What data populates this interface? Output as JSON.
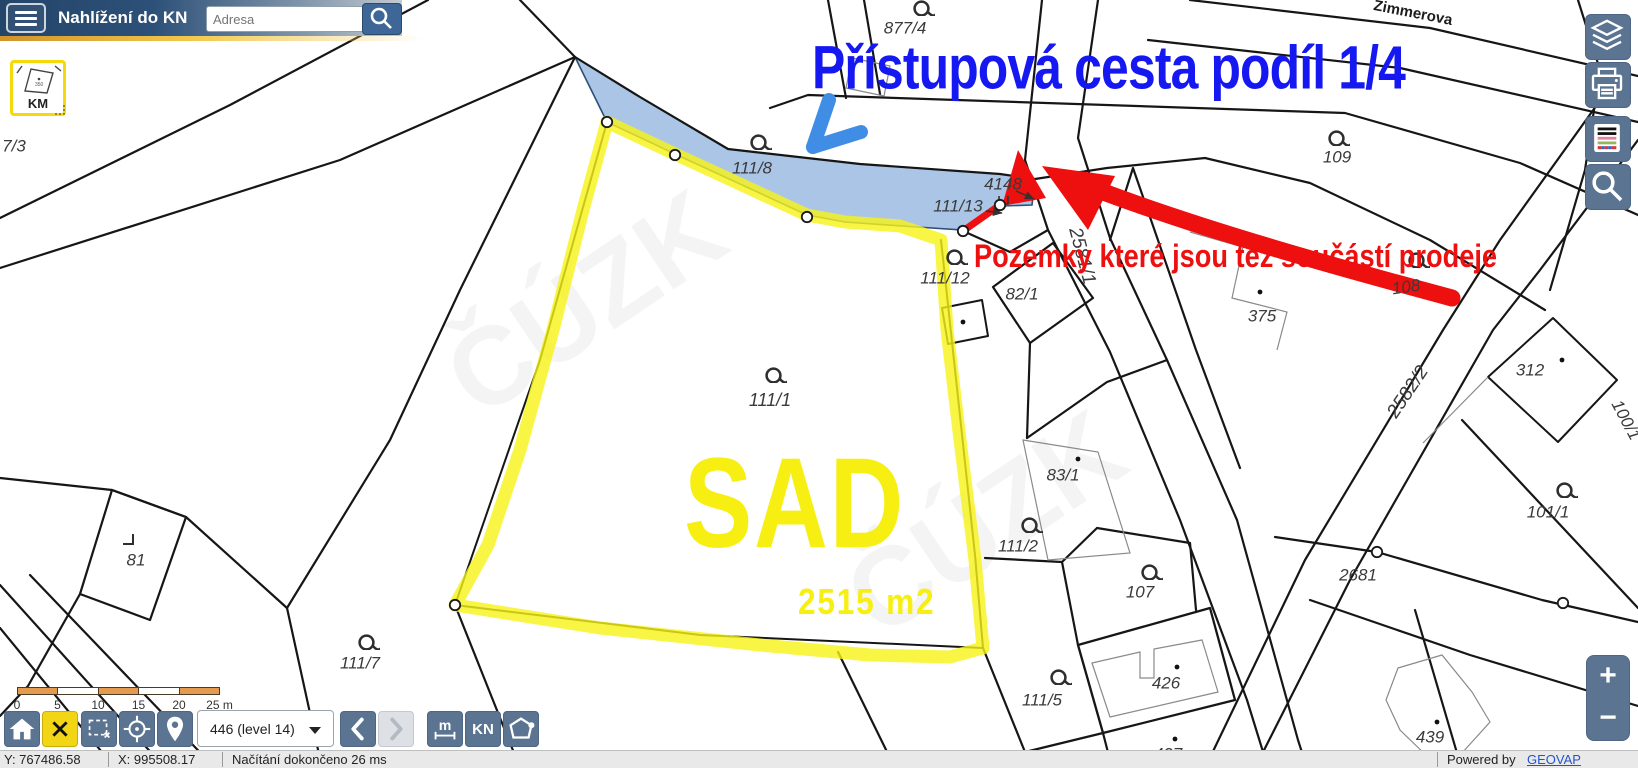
{
  "header": {
    "title": "Nahlížení do KN",
    "search_placeholder": "Adresa"
  },
  "km_button": {
    "label": "KM",
    "mini_number": "350"
  },
  "right_toolbar": {
    "icons": [
      "layers-icon",
      "print-icon",
      "legend-icon",
      "search-icon"
    ]
  },
  "annotations": {
    "blue_text": "Přístupová cesta podíl 1/4",
    "red_text": "Pozemky které jsou též součástí prodeje",
    "sad_label": "SAD",
    "area_label": "2515 m2"
  },
  "map": {
    "street_name": "Zimmerova",
    "watermark": "ČÚZK",
    "labels": [
      {
        "t": "877/4",
        "x": 905,
        "y": 28
      },
      {
        "t": "7/3",
        "x": 14,
        "y": 146
      },
      {
        "t": "111/8",
        "x": 752,
        "y": 168
      },
      {
        "t": "4148",
        "x": 1003,
        "y": 184
      },
      {
        "t": "111/13",
        "x": 958,
        "y": 206
      },
      {
        "t": "109",
        "x": 1337,
        "y": 157
      },
      {
        "t": "Zimmerova",
        "x": 1413,
        "y": 13,
        "s": 15,
        "r": 11,
        "street": true
      },
      {
        "t": "111/12",
        "x": 945,
        "y": 278
      },
      {
        "t": "82/1",
        "x": 1022,
        "y": 294
      },
      {
        "t": "375",
        "x": 1262,
        "y": 316
      },
      {
        "t": "108",
        "x": 1406,
        "y": 287,
        "r": -8
      },
      {
        "t": "2581/1",
        "x": 1082,
        "y": 256,
        "s": 19,
        "r": 75
      },
      {
        "t": "2582/2",
        "x": 1408,
        "y": 392,
        "s": 19,
        "r": -56
      },
      {
        "t": "312",
        "x": 1530,
        "y": 370
      },
      {
        "t": "100/1",
        "x": 1626,
        "y": 420,
        "r": 62
      },
      {
        "t": "83/1",
        "x": 1063,
        "y": 475
      },
      {
        "t": "111/2",
        "x": 1018,
        "y": 546
      },
      {
        "t": "101/1",
        "x": 1548,
        "y": 512
      },
      {
        "t": "107",
        "x": 1140,
        "y": 592
      },
      {
        "t": "2681",
        "x": 1358,
        "y": 575
      },
      {
        "t": "81",
        "x": 136,
        "y": 560
      },
      {
        "t": "111/7",
        "x": 360,
        "y": 663
      },
      {
        "t": "111/5",
        "x": 1042,
        "y": 700
      },
      {
        "t": "426",
        "x": 1166,
        "y": 683
      },
      {
        "t": "439",
        "x": 1430,
        "y": 737
      },
      {
        "t": "427",
        "x": 1168,
        "y": 754
      },
      {
        "t": "111/1",
        "x": 770,
        "y": 400,
        "s": 18
      }
    ],
    "orchard_symbols": [
      [
        920,
        6
      ],
      [
        757,
        140
      ],
      [
        1335,
        136
      ],
      [
        953,
        255
      ],
      [
        772,
        373
      ],
      [
        1028,
        523
      ],
      [
        1148,
        570
      ],
      [
        1057,
        675
      ],
      [
        365,
        640
      ],
      [
        1563,
        488
      ],
      [
        1415,
        258
      ]
    ],
    "building_dots": [
      [
        963,
        322
      ],
      [
        1078,
        459
      ],
      [
        1562,
        360
      ],
      [
        1177,
        667
      ],
      [
        1437,
        722
      ],
      [
        1175,
        739
      ],
      [
        1260,
        292
      ]
    ],
    "vertex_circles": [
      [
        607,
        122
      ],
      [
        675,
        155
      ],
      [
        807,
        217
      ],
      [
        963,
        231
      ],
      [
        1000,
        205
      ],
      [
        455,
        605
      ],
      [
        1377,
        552
      ],
      [
        1563,
        603
      ]
    ],
    "corner_symbol": [
      130,
      541
    ]
  },
  "bottom_toolbar": {
    "level_select": "446 (level 14)",
    "kn_label": "KN",
    "measure_label": "m",
    "scale_ticks": [
      "0",
      "5",
      "10",
      "15",
      "20",
      "25 m"
    ]
  },
  "status_bar": {
    "y_coord": "Y: 767486.58",
    "x_coord": "X: 995508.17",
    "message": "Načítání dokončeno 26 ms",
    "powered_by": "Powered by",
    "brand": "GEOVAP"
  },
  "colors": {
    "accent_yellow": "#f5d90a",
    "highlight_yellow": "#f8f216",
    "parcel_blue_fill": "#abc5e6",
    "annotation_blue": "#1518f0",
    "annotation_red": "#ee0f0f",
    "arrow_blue": "#3f8de5",
    "toolbar_slate": "#5b7492",
    "scalebar_orange": "#e49a4f",
    "header_dark": "#24456a",
    "link_blue": "#2255cc"
  }
}
